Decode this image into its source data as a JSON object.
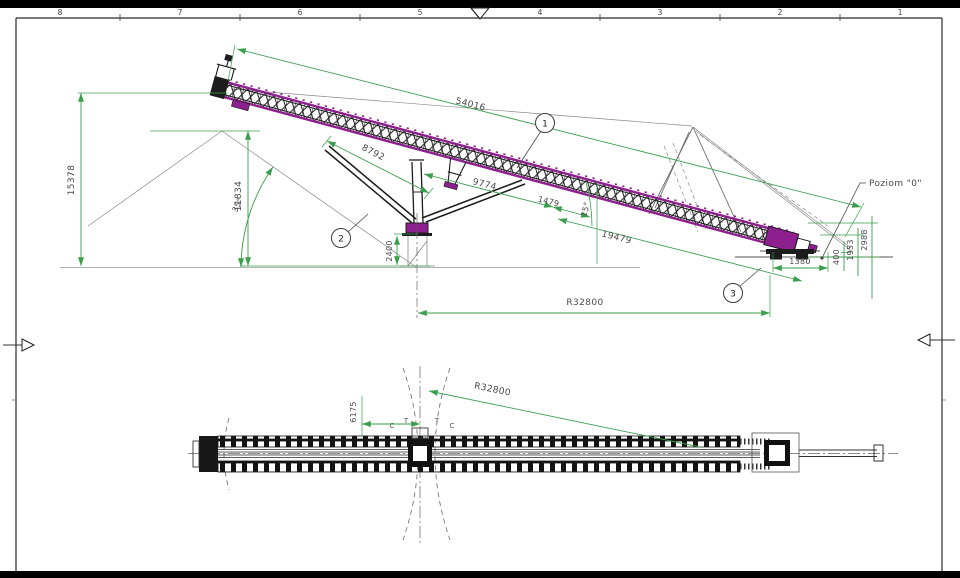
{
  "frame": {
    "ruler_top": [
      "8",
      "7",
      "6",
      "5",
      "4",
      "3",
      "2",
      "1"
    ]
  },
  "colors": {
    "dimension_green": "#3a9e4c",
    "structure_magenta": "#8e1f8e",
    "structure_black": "#1c1c1c"
  },
  "side_view": {
    "balloons": [
      "1",
      "2",
      "3"
    ],
    "labels": {
      "boom_length": "54016",
      "seg_8792": "8792",
      "seg_9774": "9774",
      "seg_1479": "1479",
      "seg_19479": "19479",
      "radius": "R32800",
      "tail_height": "15378",
      "pile_height": "11834",
      "pile_angle": "35°",
      "boom_angle": "15°",
      "pivot_height": "2400",
      "bogie_span": "1380",
      "h_400": "400",
      "h_1953": "1953",
      "h_2988": "2988",
      "level_note": "Poziom \"0\""
    }
  },
  "plan_view": {
    "labels": {
      "radius": "R32800",
      "pivot_offset": "6175"
    },
    "marks": [
      "C",
      "T",
      "T",
      "C"
    ]
  }
}
